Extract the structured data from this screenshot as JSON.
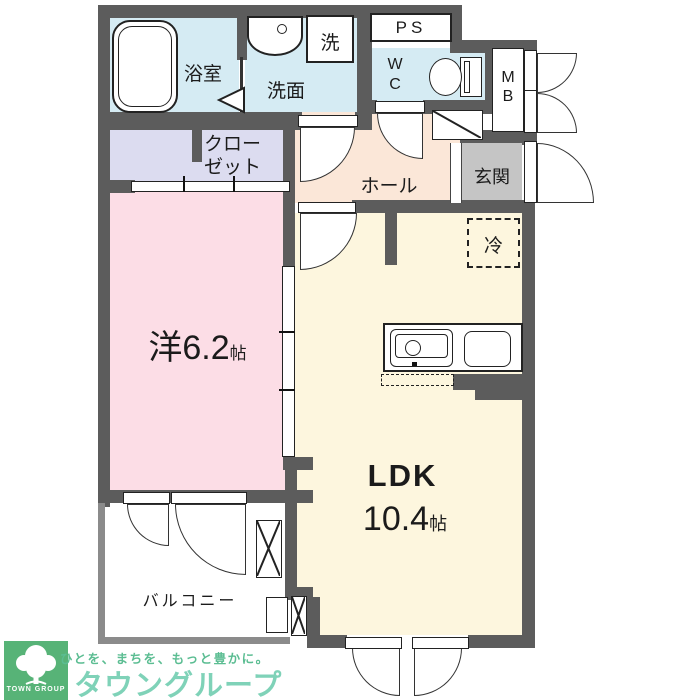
{
  "plan": {
    "bathroom": "浴室",
    "washroom": "洗面",
    "washer": "洗",
    "pipe_space": "PS",
    "wc_l1": "W",
    "wc_l2": "C",
    "mb_l1": "M",
    "mb_l2": "B",
    "closet_l1": "クロー",
    "closet_l2": "ゼット",
    "hall": "ホール",
    "entrance": "玄関",
    "fridge": "冷",
    "western_room_name": "洋6.2",
    "western_room_unit": "帖",
    "ldk_name": "LDK",
    "ldk_size": "10.4",
    "ldk_unit": "帖",
    "balcony": "バルコニー"
  },
  "logo": {
    "mark_text": "TOWN GROUP",
    "tagline": "ひとを、まちを、もっと豊かに。",
    "company": "タウングループ"
  },
  "palette": {
    "wall": "#5c5c5c",
    "wet_area_blue": "#d5ebf3",
    "closet_lavender": "#dcdcf0",
    "hall_peach": "#fbe7d8",
    "room_pink": "#fcdde6",
    "ldk_cream": "#fdf6de",
    "entrance_gray": "#c5c5c5",
    "logo_green": "#57b377",
    "logo_company_green": "#7fd2b8",
    "logo_tagline_green": "#5bbd92"
  }
}
